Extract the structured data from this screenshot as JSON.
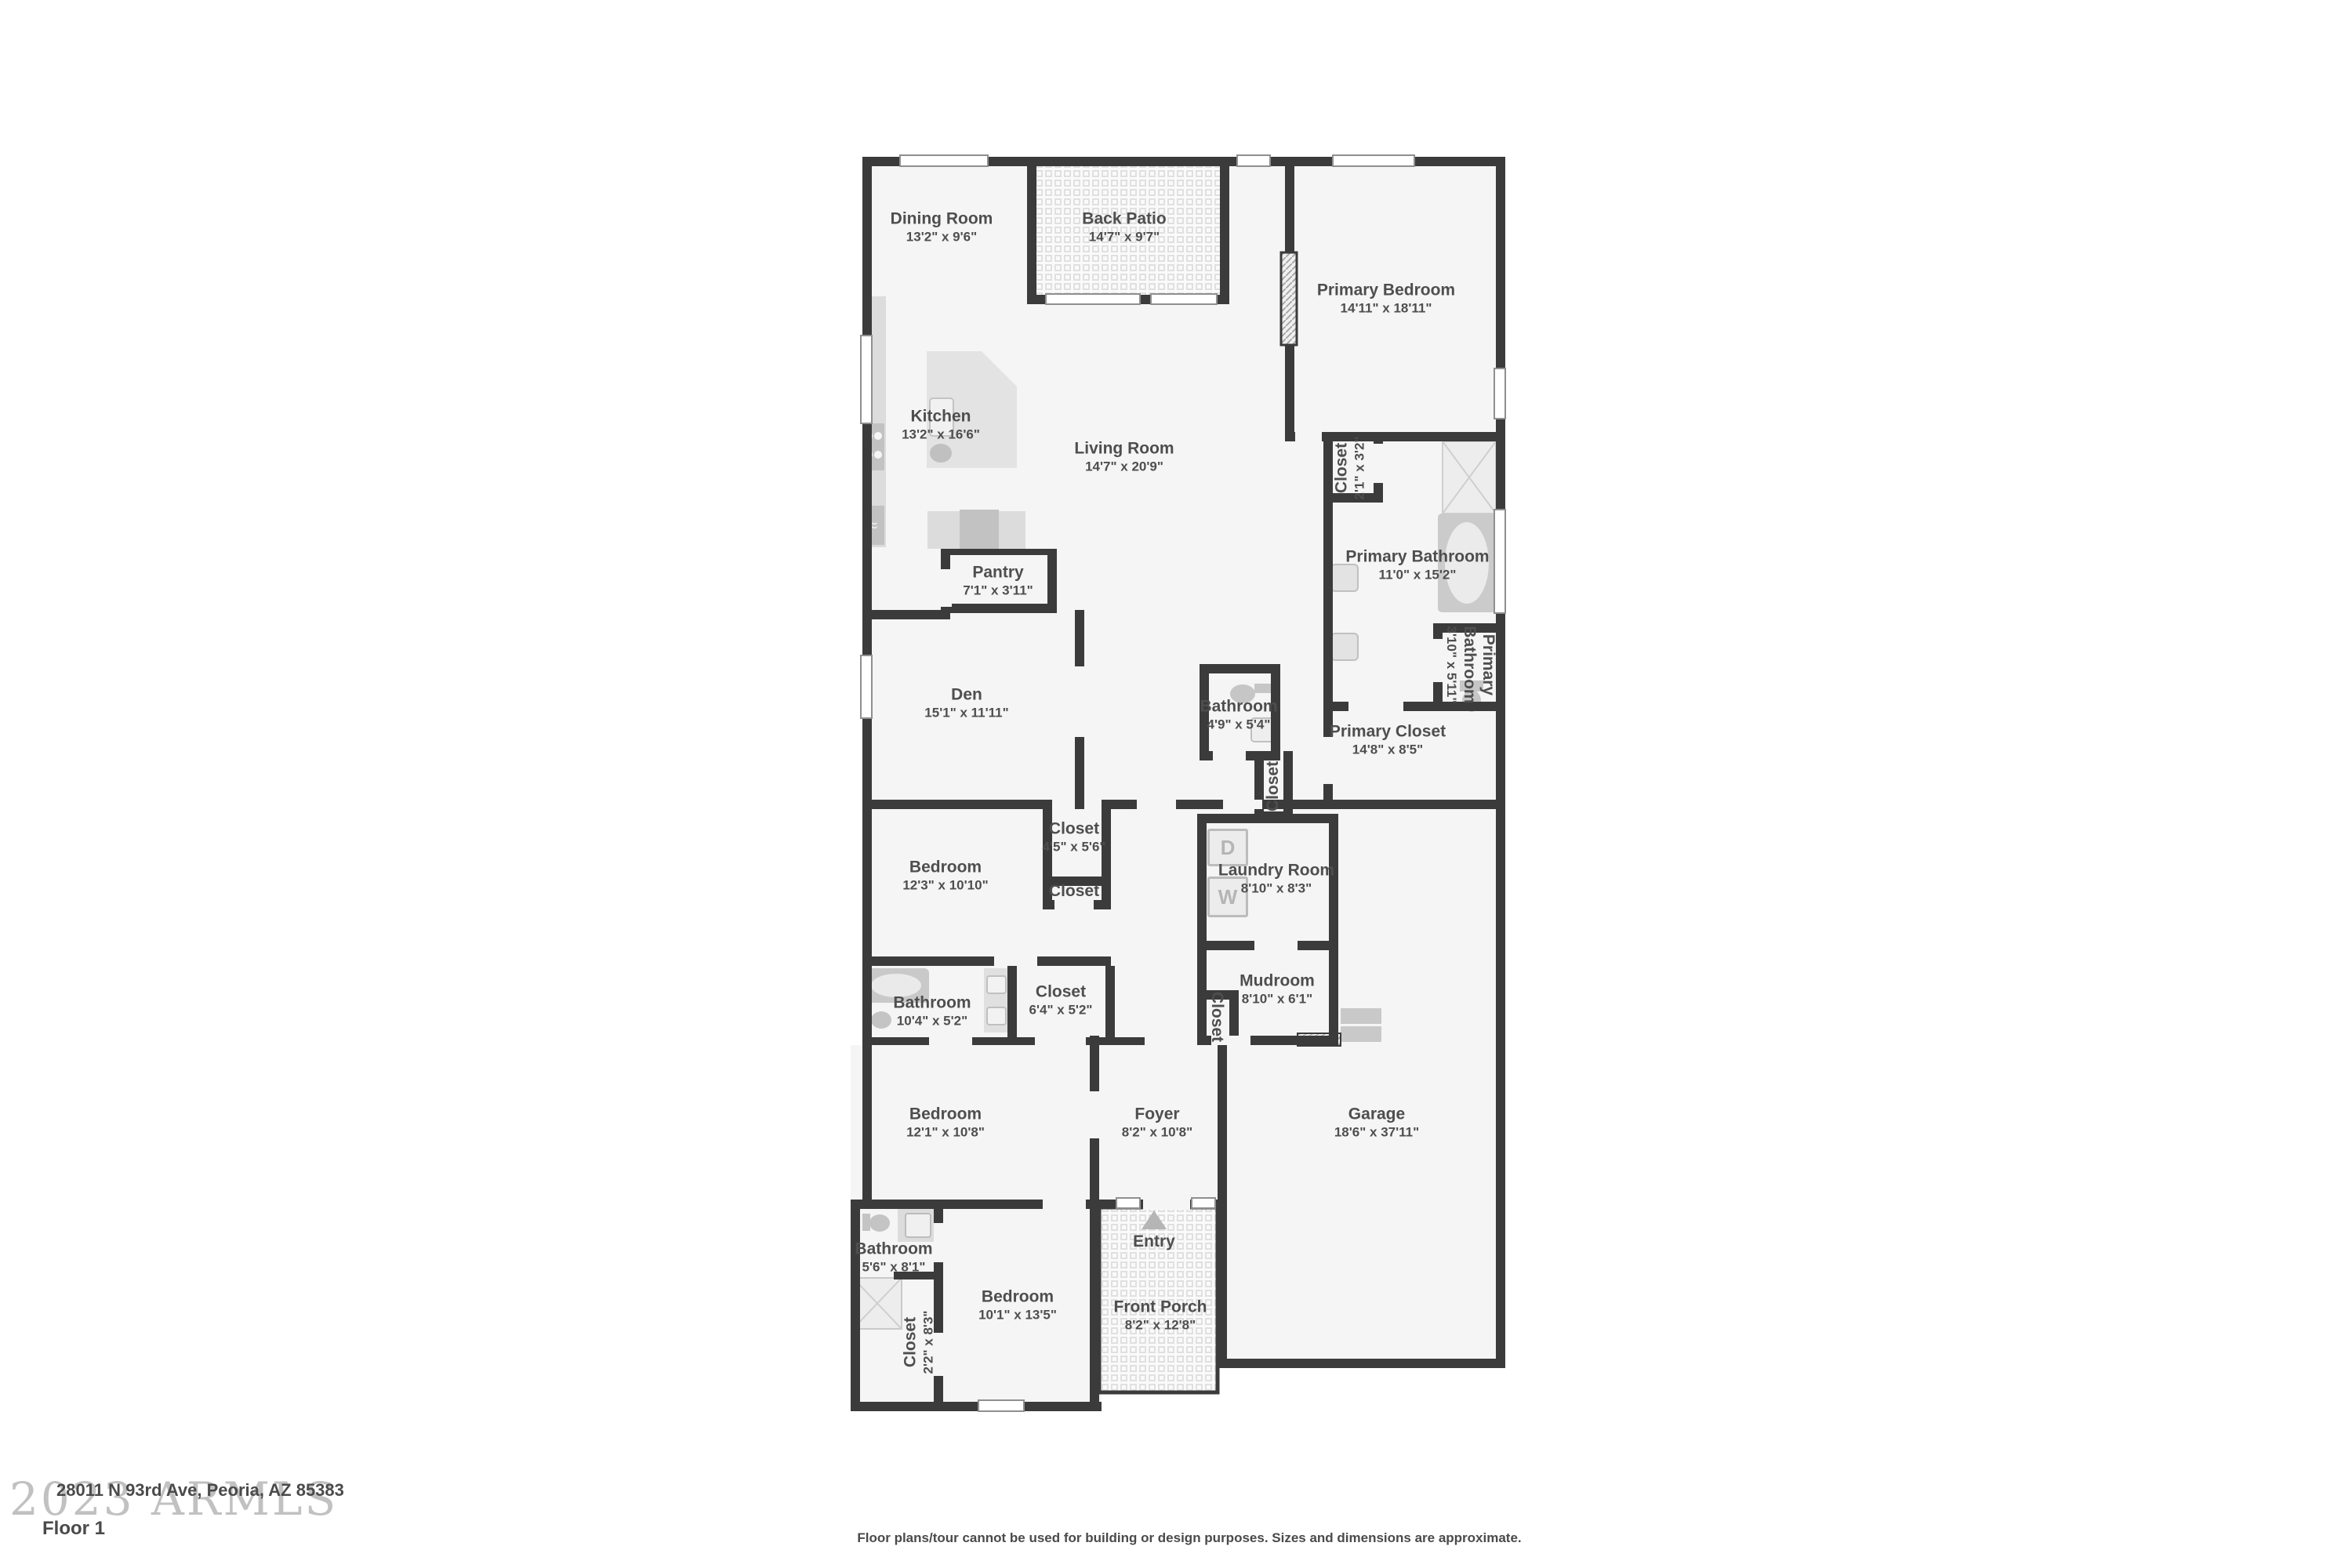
{
  "meta": {
    "address": "28011 N 93rd Ave, Peoria, AZ 85383",
    "floor_label": "Floor 1",
    "watermark": "2023 ARMLS",
    "disclaimer": "Floor plans/tour cannot be used for building or design purposes. Sizes and dimensions are approximate."
  },
  "colors": {
    "wall": "#3b3b3b",
    "floor": "#f5f5f5",
    "fixture": "#c9c9c9",
    "label_text": "#4e4e4e"
  },
  "appliances": {
    "dryer_label": "D",
    "washer_label": "W"
  },
  "rooms": [
    {
      "name": "Dining Room",
      "dims": "13'2\" x 9'6\""
    },
    {
      "name": "Back Patio",
      "dims": "14'7\" x 9'7\""
    },
    {
      "name": "Primary Bedroom",
      "dims": "14'11\" x 18'11\""
    },
    {
      "name": "Kitchen",
      "dims": "13'2\" x 16'6\""
    },
    {
      "name": "Living Room",
      "dims": "14'7\" x 20'9\""
    },
    {
      "name": "Closet",
      "dims": "2'1\" x 3'2\""
    },
    {
      "name": "Primary Bathroom",
      "dims": "11'0\" x 15'2\""
    },
    {
      "name": "Pantry",
      "dims": "7'1\" x 3'11\""
    },
    {
      "name": "Primary Bathroom",
      "dims": "3'10\" x 5'11\""
    },
    {
      "name": "Den",
      "dims": "15'1\" x 11'11\""
    },
    {
      "name": "Bathroom",
      "dims": "4'9\" x 5'4\""
    },
    {
      "name": "Primary Closet",
      "dims": "14'8\" x 8'5\""
    },
    {
      "name": "Closet",
      "dims": ""
    },
    {
      "name": "Closet",
      "dims": "4'5\" x 5'6\""
    },
    {
      "name": "Bedroom",
      "dims": "12'3\" x 10'10\""
    },
    {
      "name": "Laundry Room",
      "dims": "8'10\" x 8'3\""
    },
    {
      "name": "Closet",
      "dims": ""
    },
    {
      "name": "Bathroom",
      "dims": "10'4\" x 5'2\""
    },
    {
      "name": "Closet",
      "dims": "6'4\" x 5'2\""
    },
    {
      "name": "Mudroom",
      "dims": "8'10\" x 6'1\""
    },
    {
      "name": "Closet",
      "dims": ""
    },
    {
      "name": "Bedroom",
      "dims": "12'1\" x 10'8\""
    },
    {
      "name": "Foyer",
      "dims": "8'2\" x 10'8\""
    },
    {
      "name": "Garage",
      "dims": "18'6\" x 37'11\""
    },
    {
      "name": "Bathroom",
      "dims": "5'6\" x 8'1\""
    },
    {
      "name": "Entry",
      "dims": ""
    },
    {
      "name": "Bedroom",
      "dims": "10'1\" x 13'5\""
    },
    {
      "name": "Front Porch",
      "dims": "8'2\" x 12'8\""
    },
    {
      "name": "Closet",
      "dims": "2'2\" x 8'3\""
    }
  ]
}
